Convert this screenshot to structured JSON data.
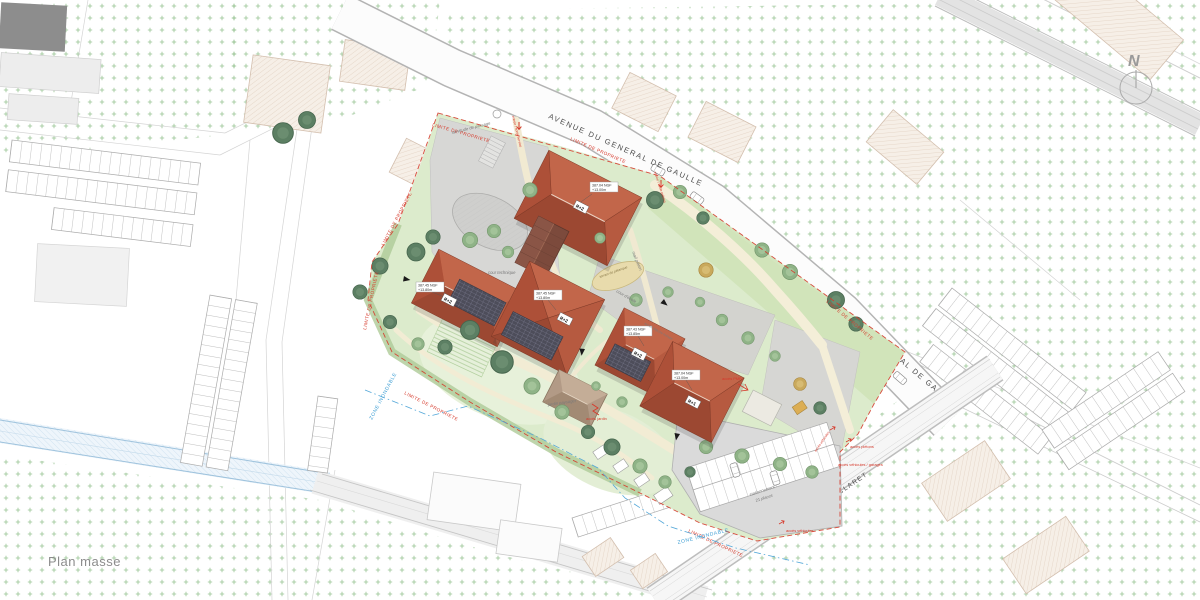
{
  "title": {
    "label": "Plan masse"
  },
  "compass": {
    "north": "N"
  },
  "streets": {
    "avenue": "AVENUE DU GENERAL DE GAULLE",
    "rue": "RUE EUGENE CLARET"
  },
  "boundaries": {
    "limite": "LIMITE DE PROPRIETE",
    "zone_inondable": "ZONE INONDABLE"
  },
  "site": {
    "servitude": "servitude de passage",
    "cour_technique": "cour technique",
    "cour_ecole": "cour d'école",
    "jardin_paysager": "jardin paysager",
    "terrain_petanque": "terrain de pétanque",
    "mail_pieton": "mail piéton",
    "stationnement_l1": "stationnement",
    "stationnement_l2": "21 places",
    "acces": {
      "pietons": "accès piétons",
      "vehicules": "accès véhicules",
      "garages": "accès véhicules / garages",
      "jardin": "accès jardin",
      "depose_minute": "accès dépose minute",
      "entree_service": "entrée / sortie service",
      "entree_pietons": "entrée / sortie piétons",
      "pmr": "accès PMR"
    }
  },
  "buildings": [
    {
      "floors": "R+2",
      "ngf": "387.04 NGF",
      "height": "+13.00m"
    },
    {
      "floors": "R+2",
      "ngf": "387.45 NGF",
      "height": "+13.80m"
    },
    {
      "floors": "R+2",
      "ngf": "387.45 NGF",
      "height": "+13.80m"
    },
    {
      "floors": "R+2",
      "ngf": "387.43 NGF",
      "height": "+13.85m"
    },
    {
      "floors": "R+1",
      "ngf": "387.04 NGF",
      "height": "+13.00m"
    }
  ]
}
